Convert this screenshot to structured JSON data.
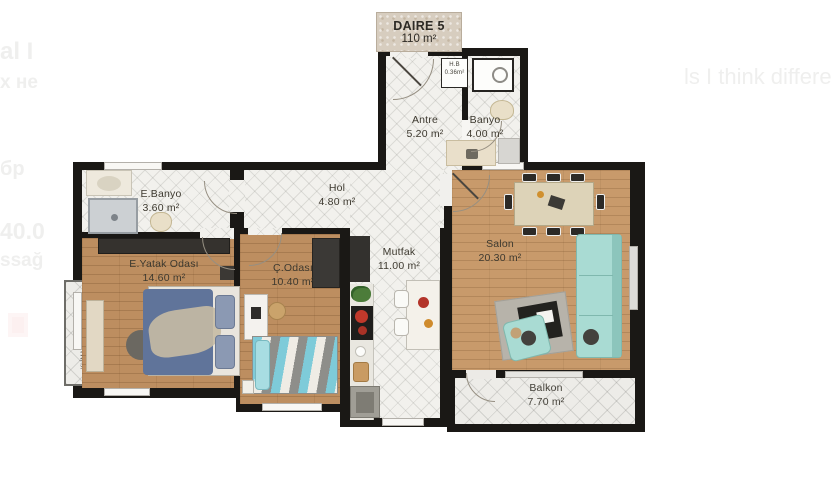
{
  "plan_header": {
    "name": "DAIRE 5",
    "area": "110 m²"
  },
  "rooms": {
    "antre": {
      "name": "Antre",
      "area": "5.20 m²"
    },
    "banyo": {
      "name": "Banyo",
      "area": "4.00 m²"
    },
    "hb": {
      "name": "H.B",
      "area": "0.36m²"
    },
    "ebanyo": {
      "name": "E.Banyo",
      "area": "3.60 m²"
    },
    "hol": {
      "name": "Hol",
      "area": "4.80 m²"
    },
    "eyatak": {
      "name": "E.Yatak Odası",
      "area": "14.60 m²"
    },
    "codasi": {
      "name": "Ç.Odası",
      "area": "10.40 m²"
    },
    "mutfak": {
      "name": "Mutfak",
      "area": "11.00 m²"
    },
    "salon": {
      "name": "Salon",
      "area": "20.30 m²"
    },
    "balkon": {
      "name": "Balkon",
      "area": "7.70 m²"
    },
    "klima": {
      "name": "KLİMA BALKONU",
      "area": "1.00 m²"
    }
  },
  "page_background_text": {
    "frag_top_left": "al I",
    "frag_left_2": "х не",
    "frag_left_3": "бр",
    "frag_left_4": "40.0",
    "frag_left_5": "ssağ",
    "frag_right": "ls I think differen"
  },
  "colors": {
    "wall": "#1a1815",
    "tile_floor": "#f2f1ed",
    "wood_floor": "#bd8e60",
    "salon_wood": "#c89a6b",
    "sofa_teal": "#a9dbd3",
    "bed_blue": "#60749a",
    "chevron_teal": "#7ecbd9",
    "accent_red": "#c0392b"
  }
}
